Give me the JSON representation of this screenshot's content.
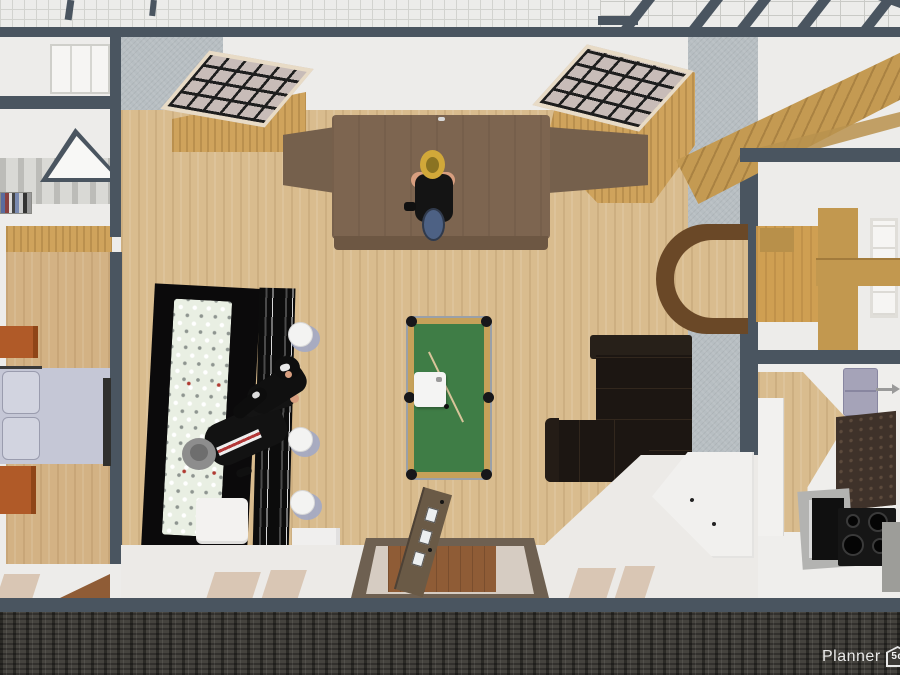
{
  "watermark": {
    "brand": "Planner",
    "badge": "5d"
  },
  "scene": {
    "view": "top-down 3d floorplan render",
    "rooms": [
      "living-room",
      "bedroom",
      "dining-room",
      "kitchen",
      "stair-hall"
    ],
    "living_room_objects": [
      "piano-table-with-player",
      "pool-table",
      "bar-counter",
      "back-bar-bottle-shelf",
      "bar-stools",
      "bartender-figure",
      "seated-figure",
      "l-shaped-sectional-sofa",
      "wall-desk",
      "entry-door-open",
      "radiator",
      "corner-sideboard",
      "grid-window-left",
      "grid-window-right"
    ],
    "bedroom_objects": [
      "double-bed",
      "nightstand-top",
      "nightstand-bottom"
    ],
    "dining_room_objects": [
      "wooden-dining-set",
      "window"
    ],
    "kitchen_objects": [
      "sink-cabinet",
      "cooktop",
      "oven",
      "tiled-floor",
      "counter"
    ],
    "stair_hall_objects": [
      "wooden-staircase"
    ],
    "colors": {
      "wall_dark": "#4a5560",
      "wall_concrete": "#b7bec2",
      "wall_white": "#edecea",
      "floor_wood": "#d9bc8e",
      "pool_felt": "#3f7d46",
      "pool_rail": "#c6a159",
      "sofa_black": "#1c1612",
      "bar_black": "#0d0c0d",
      "bed_lavender": "#c5c7d6",
      "dresser_orange": "#b05a28",
      "stair_wood": "#c49a52",
      "ground_dark": "#45433e",
      "appliance_lavender": "#a5a3b8"
    }
  }
}
